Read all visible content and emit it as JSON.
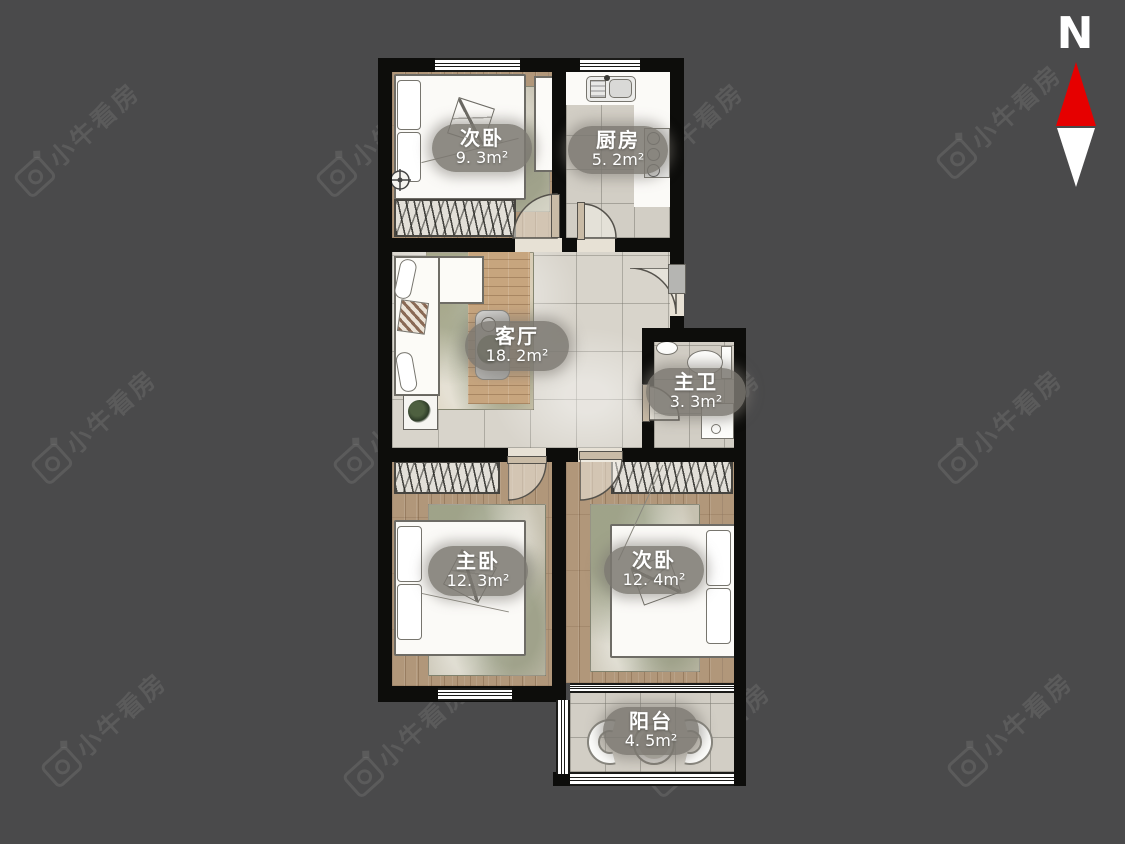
{
  "page": {
    "type": "apartment-floorplan-screenshot",
    "background": "#4a4a4b"
  },
  "compass": {
    "label": "N",
    "north_color": "#e60000",
    "south_color": "#ffffff"
  },
  "watermark": {
    "text": "小牛看房",
    "icon": "niu-camera-logo-icon",
    "color": "rgba(255,255,255,0.095)",
    "positions": [
      {
        "x": 3,
        "y": 118
      },
      {
        "x": 305,
        "y": 118
      },
      {
        "x": 607,
        "y": 118
      },
      {
        "x": 925,
        "y": 100
      },
      {
        "x": 20,
        "y": 405
      },
      {
        "x": 322,
        "y": 405
      },
      {
        "x": 624,
        "y": 405
      },
      {
        "x": 926,
        "y": 405
      },
      {
        "x": 30,
        "y": 708
      },
      {
        "x": 332,
        "y": 718
      },
      {
        "x": 634,
        "y": 718
      },
      {
        "x": 936,
        "y": 708
      }
    ]
  },
  "rooms": [
    {
      "id": "bedroom-second-top",
      "name": "次卧",
      "area": "9. 3m²"
    },
    {
      "id": "kitchen",
      "name": "厨房",
      "area": "5. 2m²"
    },
    {
      "id": "living-room",
      "name": "客厅",
      "area": "18. 2m²"
    },
    {
      "id": "master-bathroom",
      "name": "主卫",
      "area": "3. 3m²"
    },
    {
      "id": "master-bedroom",
      "name": "主卧",
      "area": "12. 3m²"
    },
    {
      "id": "bedroom-second-bottom",
      "name": "次卧",
      "area": "12. 4m²"
    },
    {
      "id": "balcony",
      "name": "阳台",
      "area": "4. 5m²"
    }
  ],
  "palette": {
    "wall": "#0d0d0b",
    "wood_floor": "#b1977a",
    "tile_floor": "#d8d4cb",
    "label_bubble": "#7b7871",
    "door_leaf": "#c9bba6"
  }
}
